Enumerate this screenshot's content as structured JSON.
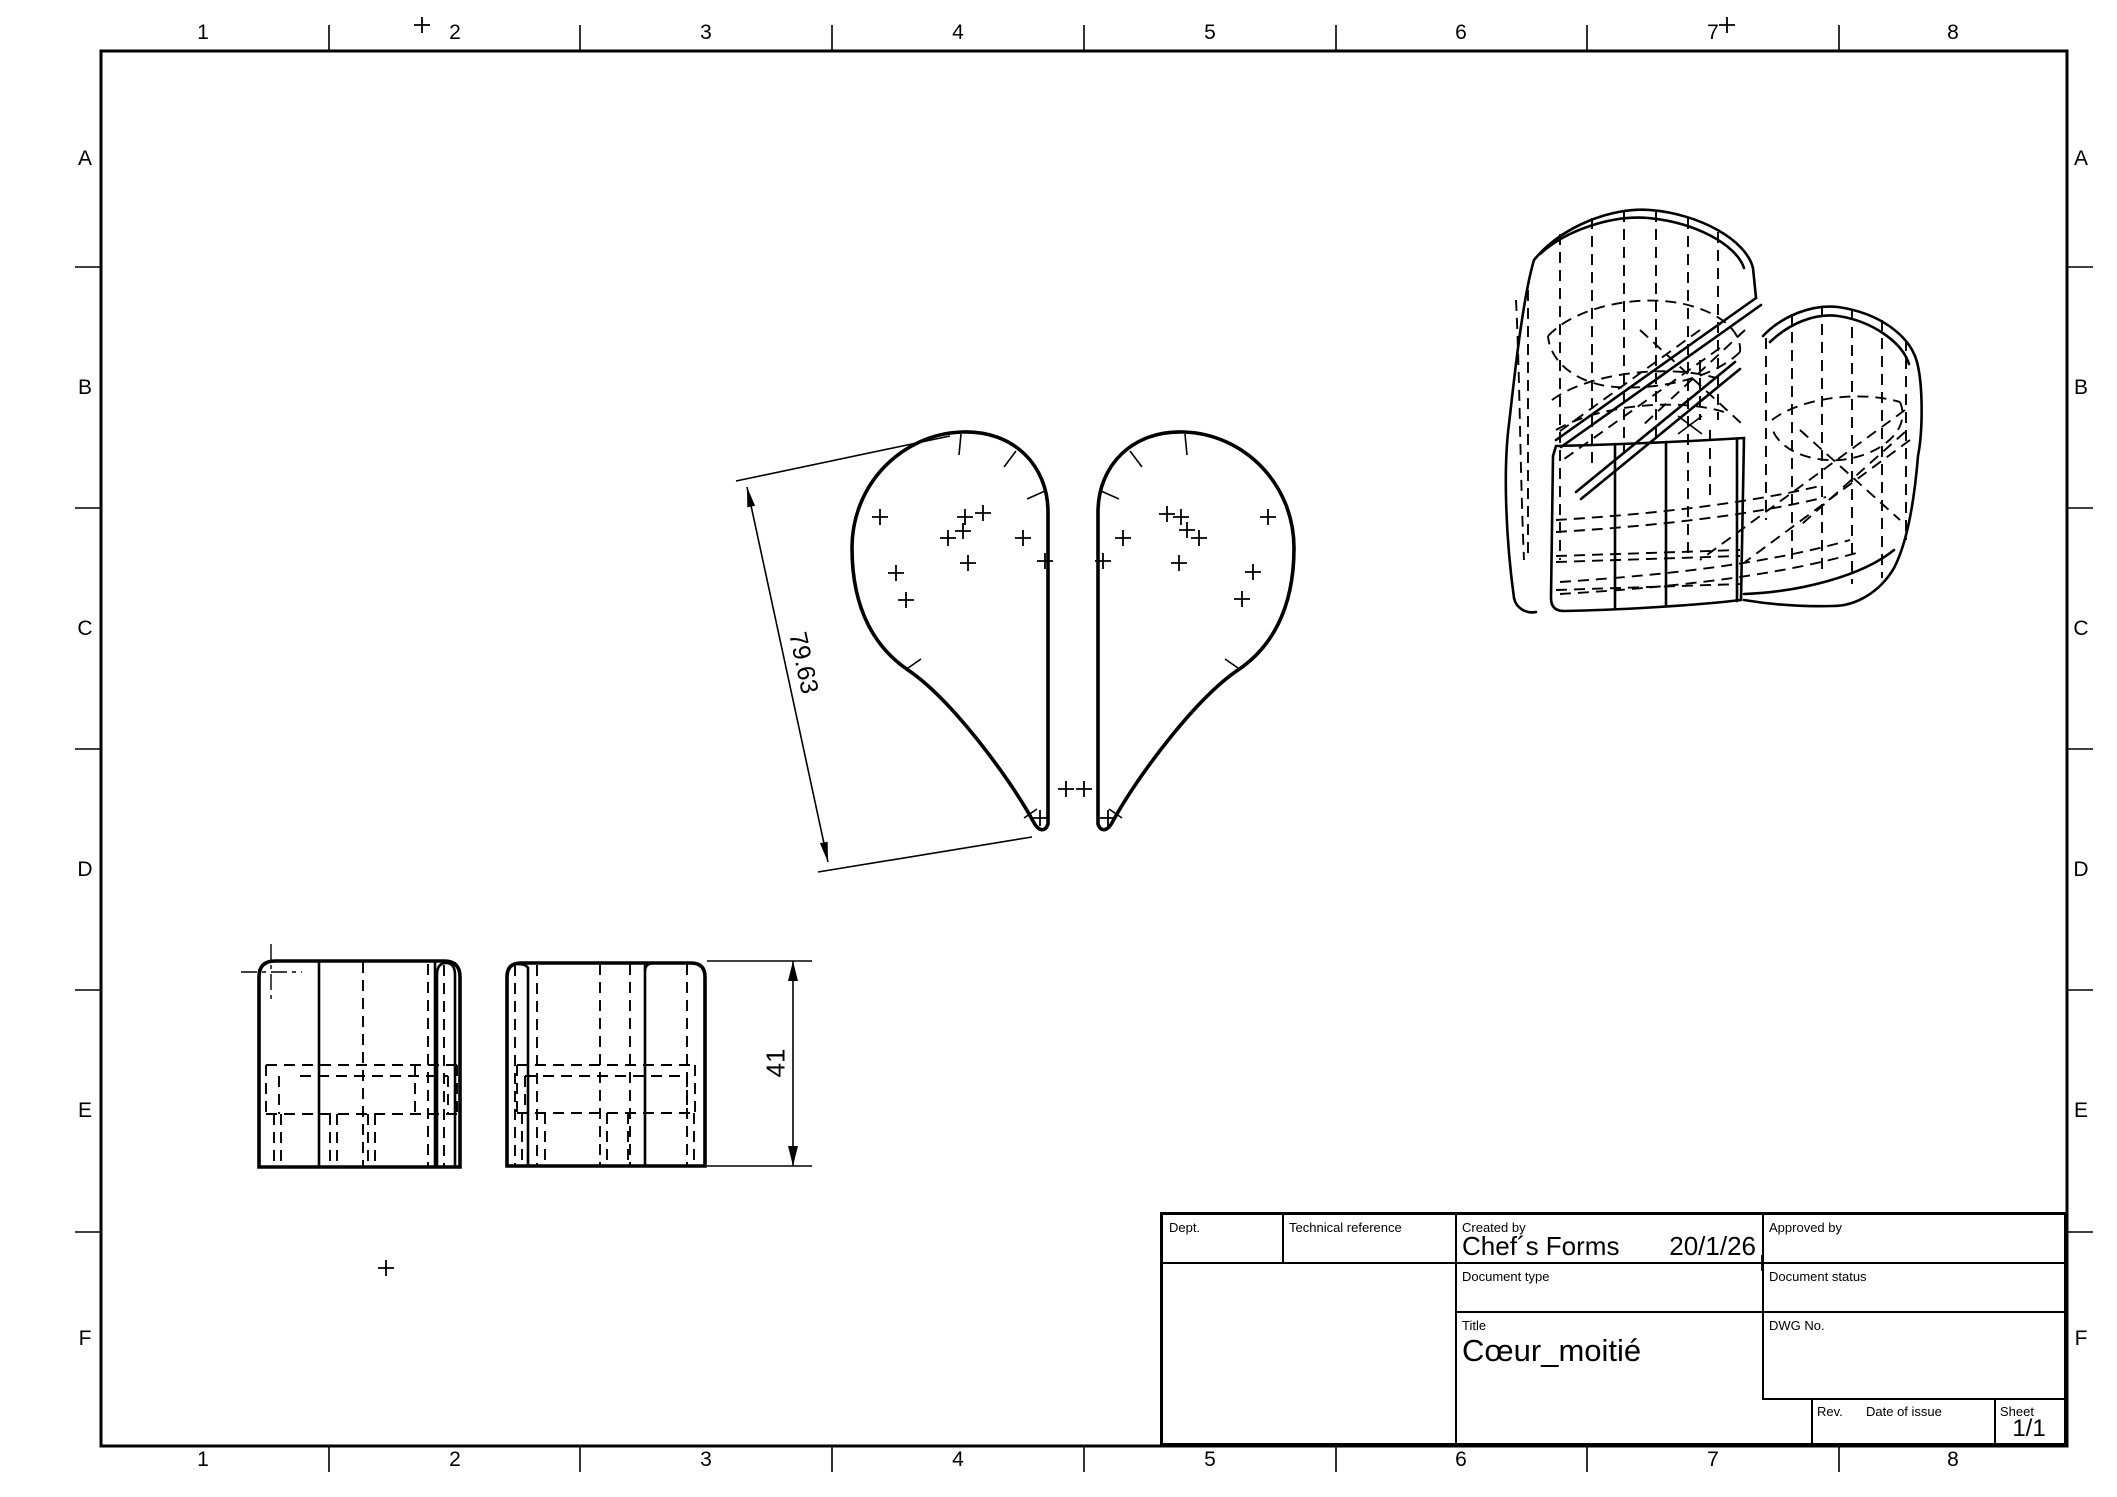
{
  "sheet": {
    "grid_columns": [
      "1",
      "2",
      "3",
      "4",
      "5",
      "6",
      "7",
      "8"
    ],
    "grid_rows": [
      "A",
      "B",
      "C",
      "D",
      "E",
      "F"
    ]
  },
  "dimensions": {
    "heart_half_length": "79.63",
    "body_height": "41"
  },
  "title_block": {
    "dept_label": "Dept.",
    "technical_reference_label": "Technical reference",
    "created_by_label": "Created by",
    "created_by_value": "Chef´s Forms",
    "created_date": "20/1/26",
    "approved_by_label": "Approved by",
    "document_type_label": "Document type",
    "document_status_label": "Document status",
    "title_label": "Title",
    "title_value": "Cœur_moitié",
    "dwg_no_label": "DWG No.",
    "rev_label": "Rev.",
    "date_of_issue_label": "Date of issue",
    "sheet_label": "Sheet",
    "sheet_value": "1/1"
  },
  "colors": {
    "ink": "#000000",
    "paper": "#ffffff"
  }
}
